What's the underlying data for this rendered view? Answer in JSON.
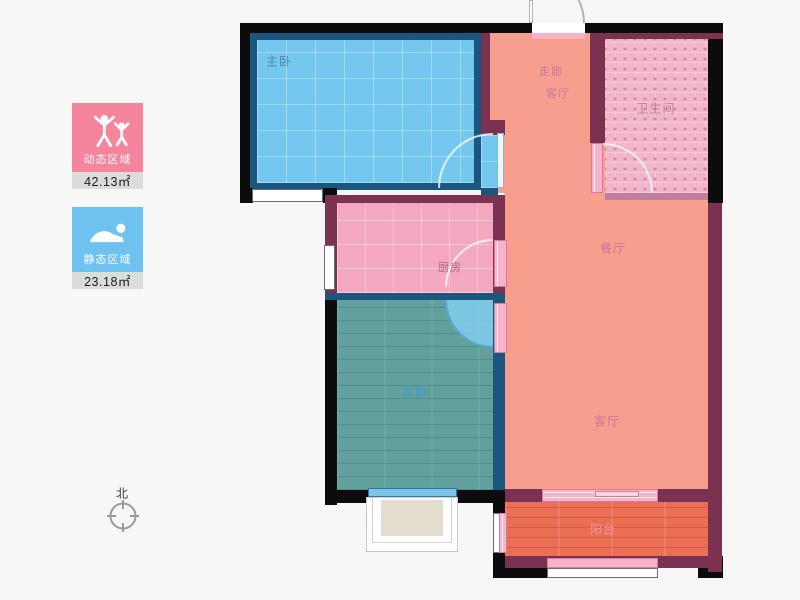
{
  "plan": {
    "rooms": [
      {
        "name": "master-bedroom",
        "label": "主卧",
        "floor_color": "#74c8ef"
      },
      {
        "name": "corridor",
        "label": "走廊",
        "floor_color": "#f89e8f"
      },
      {
        "name": "hall-upper",
        "label": "客厅",
        "floor_color": "#f89e8f"
      },
      {
        "name": "bathroom",
        "label": "卫生间",
        "floor_color": "#f2b4c9"
      },
      {
        "name": "dining-room",
        "label": "餐厅",
        "floor_color": "#f89e8f"
      },
      {
        "name": "kitchen",
        "label": "厨房",
        "floor_color": "#f3a8bf"
      },
      {
        "name": "second-bedroom",
        "label": "次卧",
        "floor_color": "#61a09c"
      },
      {
        "name": "living-room",
        "label": "客厅",
        "floor_color": "#f89e8f"
      },
      {
        "name": "balcony",
        "label": "阳台",
        "floor_color": "#eb6f54"
      }
    ]
  },
  "legend": {
    "items": [
      {
        "label": "动态区域",
        "area": "42.13㎡",
        "icon": "people-active-icon",
        "color": "#f5859c"
      },
      {
        "label": "静态区域",
        "area": "23.18㎡",
        "icon": "person-resting-icon",
        "color": "#6ec2ef"
      }
    ]
  },
  "compass": {
    "label": "北"
  },
  "palette": {
    "wall_outer": "#0c0c0c",
    "wall_inner": "#7b3150",
    "wall_bedroom": "#1a567e",
    "door_leaf": "#f7b3c9",
    "window": "#ffffff",
    "background": "#f7f7f7"
  }
}
